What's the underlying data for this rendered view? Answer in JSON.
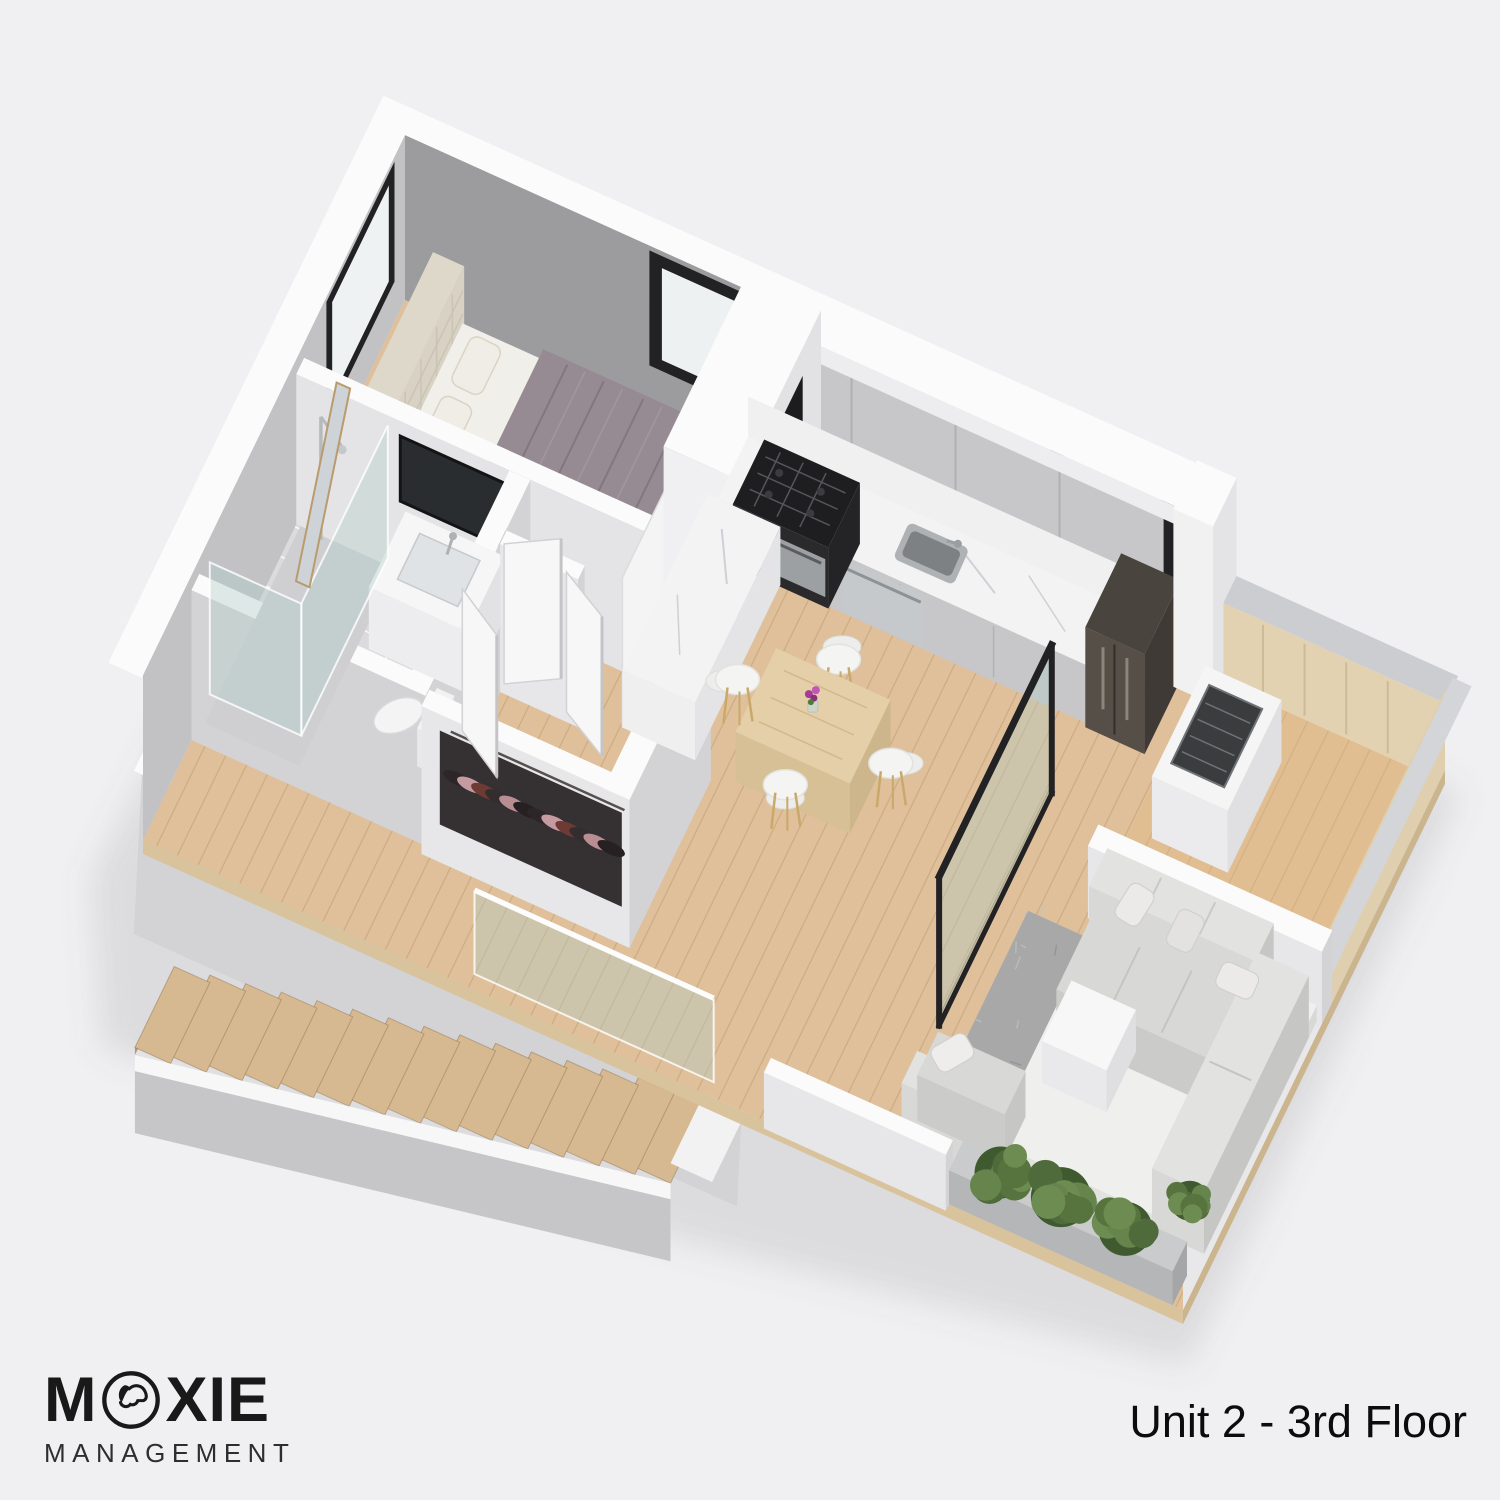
{
  "logo": {
    "brand_name": "MOXIE",
    "word_start": "M",
    "word_end": "XIE",
    "subtitle": "MANAGEMENT",
    "dog_icon": "dog-head-in-circle"
  },
  "caption": {
    "text": "Unit 2 - 3rd Floor"
  },
  "palette": {
    "bg": "#f0f0f2",
    "shadow": "rgba(110,110,125,0.16)",
    "wall_top": "#fbfbfb",
    "wall_light": "#e7e7e9",
    "wall_mid": "#d3d3d5",
    "wall_dark": "#bfbfc2",
    "accent_wall": "#9c9c9f",
    "left_wall_face": "#c2c2c5",
    "wood": "#dfc09a",
    "wood_line": "rgba(150,110,65,0.25)",
    "terrace_wood": "rgba(226,185,130,0.35)",
    "stair_wood": "#d6b990",
    "stair_riser": "#b49a74",
    "tile": "#dbdbdd",
    "tile_line": "rgba(255,255,255,0.85)",
    "cabinet": "#c7c7c9",
    "cabinet_dark": "#b2b2b5",
    "counter": "#f3f3f4",
    "marble_vein": "rgba(140,140,155,0.35)",
    "stove": "#1e1e20",
    "steel": "#aeb2b5",
    "steel_dark": "#83878a",
    "fridge": "#564f47",
    "fridge_dark": "#3f3a35",
    "bed_frame": "#e9e5da",
    "headboard": "#ded8ca",
    "mattress": "#f0efe9",
    "bedding": "#968b93",
    "bedding_dark": "#7e7580",
    "pillow": "#f0ede7",
    "sofa": "#d8d8d6",
    "sofa_light": "#e2e2e0",
    "sofa_dark": "#c6c6c4",
    "rug": "#a8a8a8",
    "table_wood": "#e5cfa8",
    "chair": "#f4f4f2",
    "chair_leg": "#c9a96a",
    "glass": "rgba(175,205,200,0.38)",
    "glass_edge": "rgba(255,255,255,0.8)",
    "frame_dark": "#222224",
    "plant_dark": "#3f5a2e",
    "plant": "#4f6a3b",
    "plant_light": "#65854c",
    "planter": "#b4b6b8",
    "ink": "#191919"
  }
}
